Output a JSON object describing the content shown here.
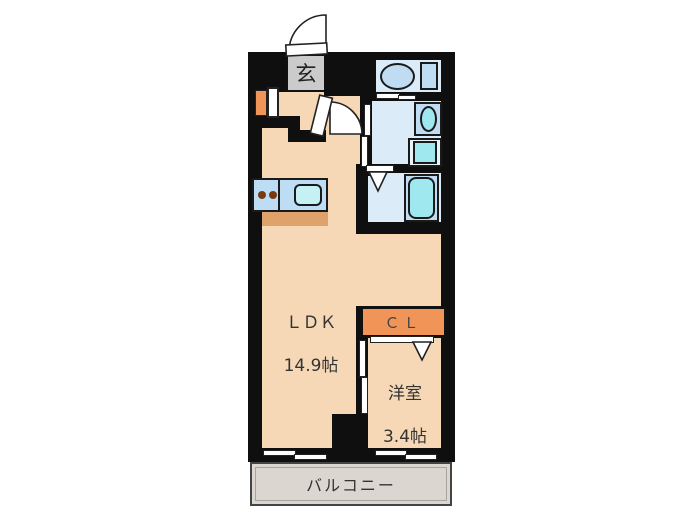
{
  "title": "floor-plan",
  "rooms": {
    "entrance": {
      "label": "玄"
    },
    "ldk": {
      "label": "ＬＤＫ",
      "size": "14.9帖"
    },
    "closet": {
      "label": "ＣＬ"
    },
    "western": {
      "label": "洋室",
      "size": "3.4帖"
    },
    "balcony": {
      "label": "バルコニー"
    }
  },
  "fixtures": [
    {
      "name": "toilet"
    },
    {
      "name": "sink"
    },
    {
      "name": "washing-machine-pan"
    },
    {
      "name": "bathtub"
    },
    {
      "name": "kitchen-counter-with-burners-and-sink"
    }
  ],
  "colors": {
    "wall": "#0f0f0f",
    "floor": "#f6d8b6",
    "waterRoom": "#dcebf8",
    "fixtureBlue": "#bfdcf2",
    "teal": "#9fe8ef",
    "accentOrange": "#f09457",
    "counterShadow": "#dfa26b",
    "balconyGray": "#dbd6cf",
    "genkanGray": "#cbcbcb"
  }
}
